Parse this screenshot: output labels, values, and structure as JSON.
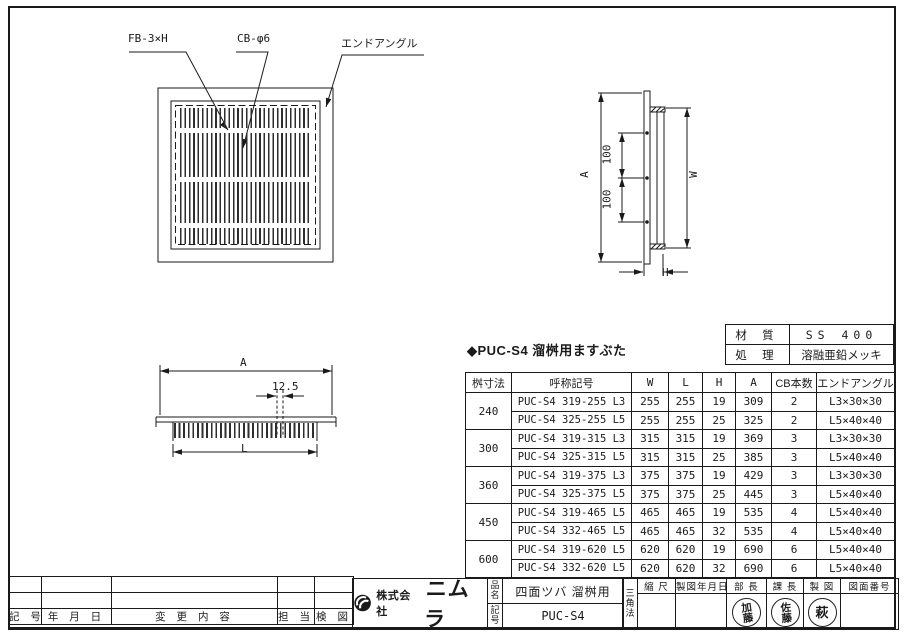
{
  "drawing": {
    "plan": {
      "label_fb": "FB-3×H",
      "label_cb": "CB-φ6",
      "label_end_angle": "エンドアングル"
    },
    "side": {
      "dim_a": "A",
      "dim_w": "W",
      "dim_h": "H",
      "dim_100a": "100",
      "dim_100b": "100"
    },
    "section": {
      "dim_a": "A",
      "dim_l": "L",
      "dim_pitch": "12.5"
    }
  },
  "material_table": {
    "rows": [
      {
        "label": "材 質",
        "value": "SS 400"
      },
      {
        "label": "処 理",
        "value": "溶融亜鉛メッキ"
      }
    ]
  },
  "spec_table": {
    "title": "◆PUC-S4 溜桝用ますぶた",
    "headers": [
      "桝寸法",
      "呼称記号",
      "W",
      "L",
      "H",
      "A",
      "CB本数",
      "エンドアングル"
    ],
    "groups": [
      {
        "size": "240",
        "rows": [
          [
            "PUC-S4 319-255 L3",
            "255",
            "255",
            "19",
            "309",
            "2",
            "L3×30×30"
          ],
          [
            "PUC-S4 325-255 L5",
            "255",
            "255",
            "25",
            "325",
            "2",
            "L5×40×40"
          ]
        ]
      },
      {
        "size": "300",
        "rows": [
          [
            "PUC-S4 319-315 L3",
            "315",
            "315",
            "19",
            "369",
            "3",
            "L3×30×30"
          ],
          [
            "PUC-S4 325-315 L5",
            "315",
            "315",
            "25",
            "385",
            "3",
            "L5×40×40"
          ]
        ]
      },
      {
        "size": "360",
        "rows": [
          [
            "PUC-S4 319-375 L3",
            "375",
            "375",
            "19",
            "429",
            "3",
            "L3×30×30"
          ],
          [
            "PUC-S4 325-375 L5",
            "375",
            "375",
            "25",
            "445",
            "3",
            "L5×40×40"
          ]
        ]
      },
      {
        "size": "450",
        "rows": [
          [
            "PUC-S4 319-465 L5",
            "465",
            "465",
            "19",
            "535",
            "4",
            "L5×40×40"
          ],
          [
            "PUC-S4 332-465 L5",
            "465",
            "465",
            "32",
            "535",
            "4",
            "L5×40×40"
          ]
        ]
      },
      {
        "size": "600",
        "rows": [
          [
            "PUC-S4 319-620 L5",
            "620",
            "620",
            "19",
            "690",
            "6",
            "L5×40×40"
          ],
          [
            "PUC-S4 332-620 L5",
            "620",
            "620",
            "32",
            "690",
            "6",
            "L5×40×40"
          ]
        ]
      }
    ]
  },
  "revision_table": {
    "headers": [
      "記 号",
      "年  月  日",
      "変 更 内 容",
      "担 当",
      "検 図"
    ]
  },
  "title_block": {
    "company_prefix": "株式会社",
    "company_name": "ニムラ",
    "name_label": "品名",
    "name_value": "四面ツバ 溜桝用",
    "code_label": "記号",
    "code_value": "PUC-S4",
    "projection": "三角法",
    "headers": [
      "縮 尺",
      "製図年月日",
      "部 長",
      "課 長",
      "製 図",
      "図面番号"
    ],
    "stamps": [
      "加藤",
      "佐藤",
      "萩"
    ]
  },
  "colors": {
    "line": "#1a1a1a",
    "paper": "#ffffff"
  }
}
